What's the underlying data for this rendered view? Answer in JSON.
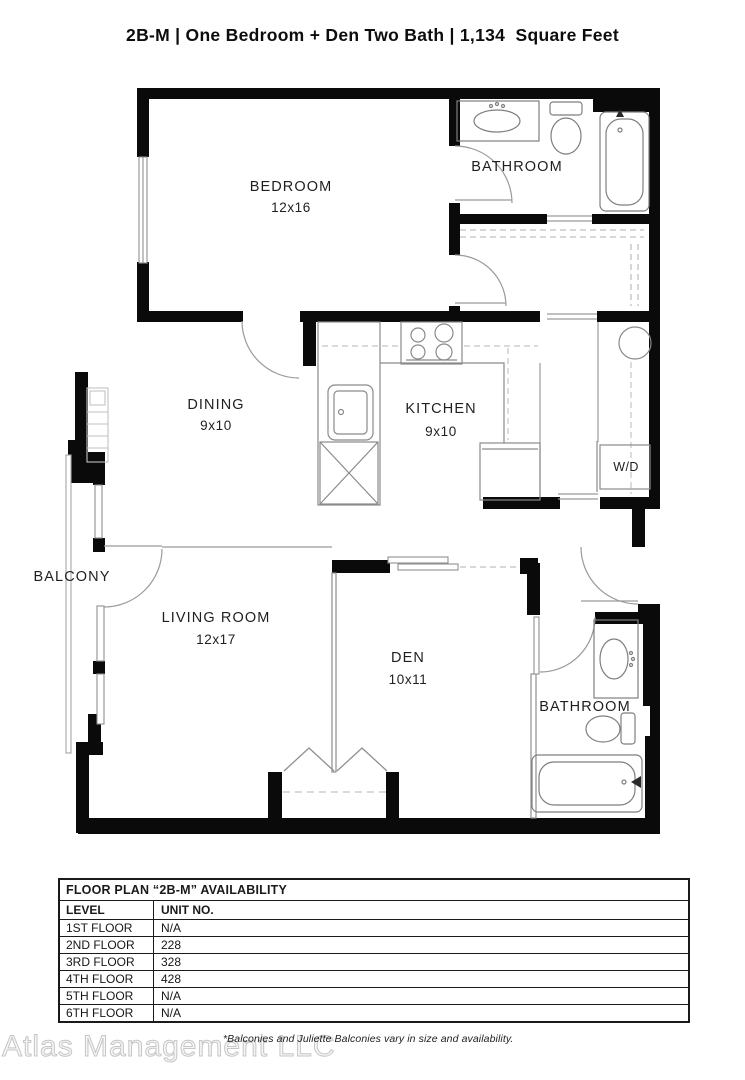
{
  "page": {
    "title": "2B-M | One Bedroom + Den Two Bath | 1,134  Square Feet"
  },
  "floor_plan": {
    "rooms": [
      {
        "name": "BEDROOM",
        "dims": "12x16"
      },
      {
        "name": "BATHROOM",
        "dims": ""
      },
      {
        "name": "DINING",
        "dims": "9x10"
      },
      {
        "name": "KITCHEN",
        "dims": "9x10"
      },
      {
        "name": "W/D",
        "dims": ""
      },
      {
        "name": "BALCONY",
        "dims": ""
      },
      {
        "name": "LIVING ROOM",
        "dims": "12x17"
      },
      {
        "name": "DEN",
        "dims": "10x11"
      },
      {
        "name": "BATHROOM",
        "dims": ""
      }
    ]
  },
  "availability_table": {
    "title": "FLOOR PLAN “2B-M” AVAILABILITY",
    "columns": [
      "LEVEL",
      "UNIT NO."
    ],
    "rows": [
      {
        "level": "1ST FLOOR",
        "unit": "N/A"
      },
      {
        "level": "2ND FLOOR",
        "unit": "228"
      },
      {
        "level": "3RD FLOOR",
        "unit": "328"
      },
      {
        "level": "4TH FLOOR",
        "unit": "428"
      },
      {
        "level": "5TH FLOOR",
        "unit": "N/A"
      },
      {
        "level": "6TH FLOOR",
        "unit": "N/A"
      }
    ]
  },
  "footnote": "*Balconies and Juliette Balconies vary in size and availability.",
  "watermark": "Atlas Management LLC",
  "colors": {
    "wall": "#0a0a0a",
    "thin_line": "#8f8f8f",
    "dashed_line": "#c0c0c0",
    "text": "#1a1a1a",
    "watermark_fill": "#f6f6f6",
    "watermark_stroke": "#c6c6c6"
  }
}
